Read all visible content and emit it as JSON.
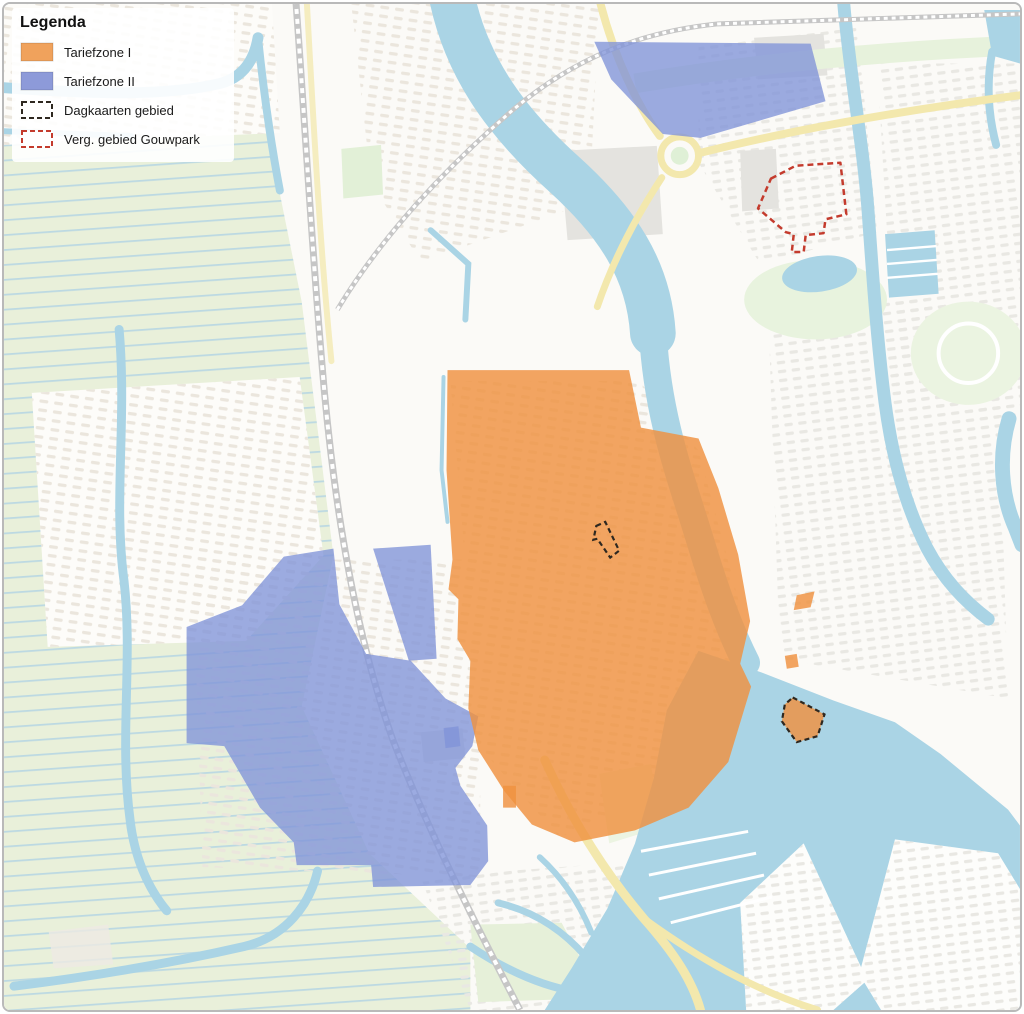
{
  "legend": {
    "title": "Legenda",
    "items": [
      {
        "label": "Tariefzone I"
      },
      {
        "label": "Tariefzone II"
      },
      {
        "label": "Dagkaarten gebied"
      },
      {
        "label": "Verg. gebied Gouwpark"
      }
    ]
  },
  "colors": {
    "tariefzone1_fill": "#ef913f",
    "tariefzone1_swatch": "#f0a25c",
    "tariefzone2_fill": "#8093d8",
    "tariefzone2_swatch": "#8d9ad9",
    "dagkaarten_outline": "#2e2820",
    "gouwpark_outline": "#c43b2d",
    "water": "#aad4e5",
    "polder_green": "#e9f0da",
    "road_yellow": "#f3e8ad",
    "railway_grey": "#c6c6c6"
  }
}
